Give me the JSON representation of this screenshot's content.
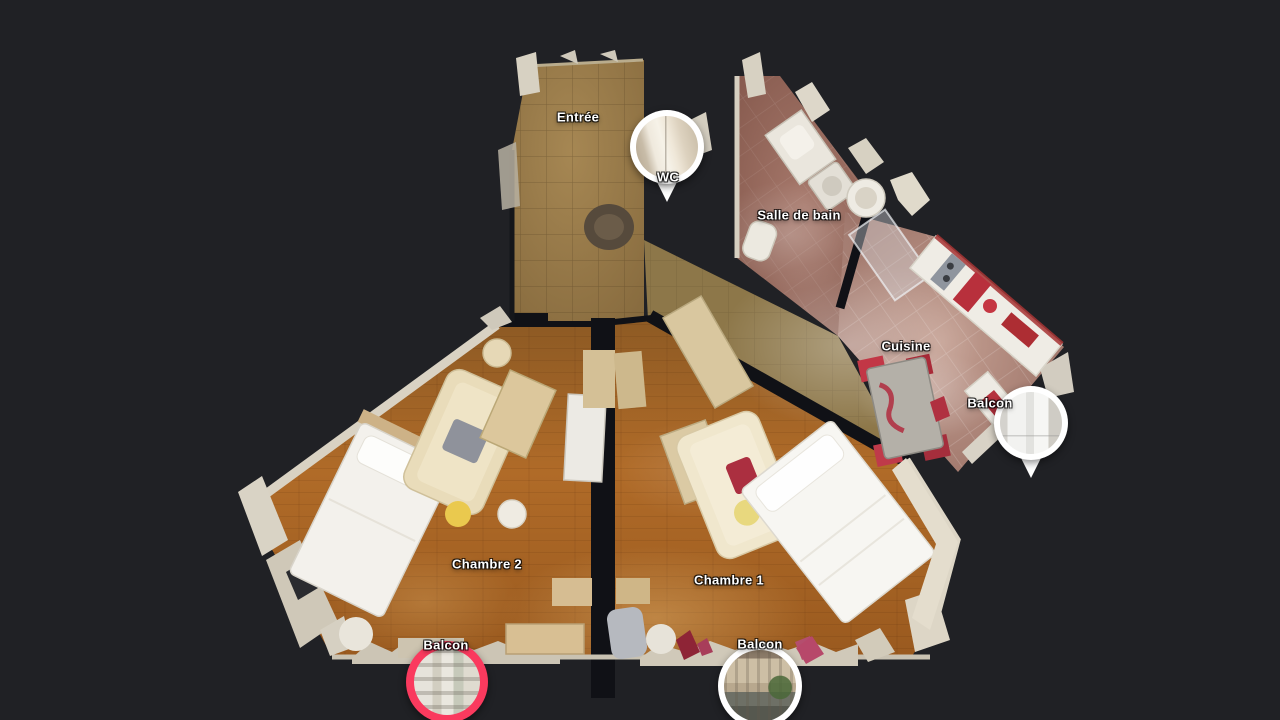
{
  "background": "#202125",
  "colors": {
    "pin_highlight": "#fa3a5e",
    "pin_default": "#ffffff",
    "label_text": "#ffffff"
  },
  "labels": {
    "entree": "Entrée",
    "wc": "WC",
    "salle_de_bain": "Salle de bain",
    "cuisine": "Cuisine",
    "balcon_cuisine": "Balcon",
    "chambre_2": "Chambre 2",
    "chambre_1": "Chambre 1",
    "balcon_chambre_2": "Balcon",
    "balcon_chambre_1": "Balcon"
  },
  "pins": [
    {
      "id": "wc",
      "room": "WC",
      "style": "default",
      "preview": "hallway-with-white-doors"
    },
    {
      "id": "balcon-cuisine",
      "room": "Balcon",
      "style": "default",
      "preview": "bright-window-view"
    },
    {
      "id": "balcon-chambre-2",
      "room": "Balcon",
      "style": "highlighted",
      "preview": "building-facade-view"
    },
    {
      "id": "balcon-chambre-1",
      "room": "Balcon",
      "style": "default",
      "preview": "street-and-buildings-view"
    }
  ]
}
